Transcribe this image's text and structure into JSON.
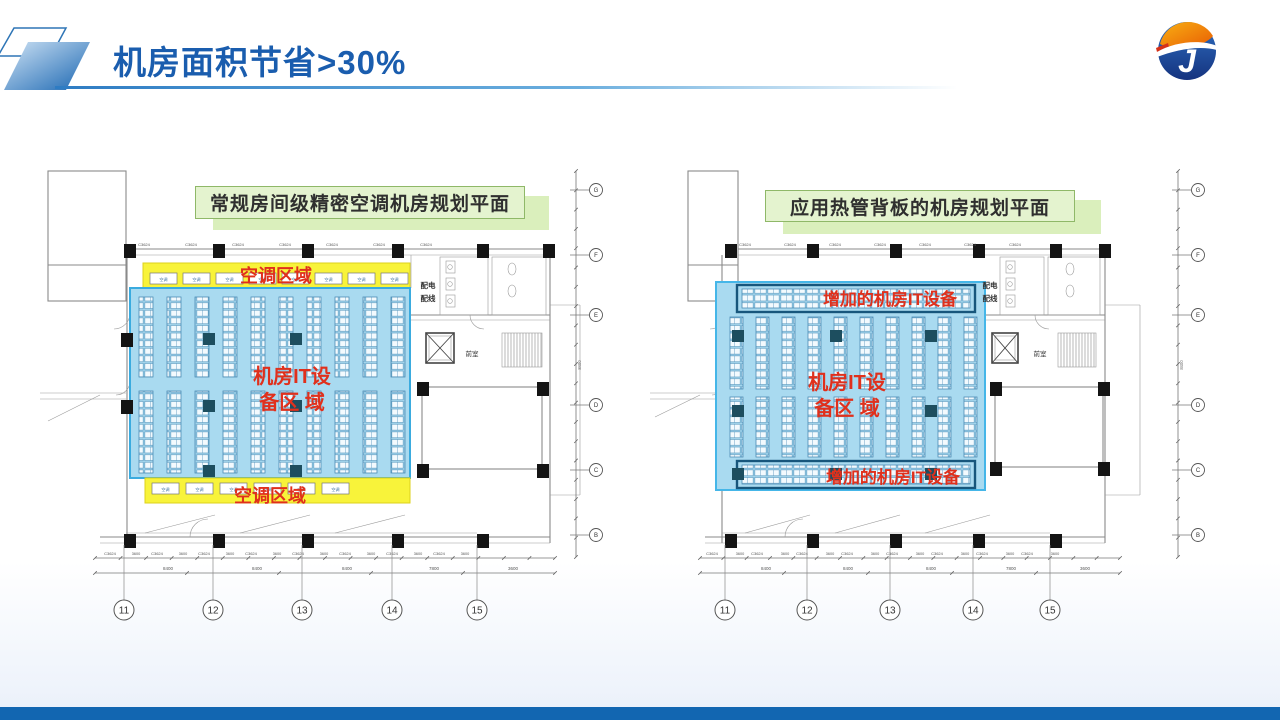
{
  "header": {
    "title": "机房面积节省>30%"
  },
  "plan_left": {
    "caption": "常规房间级精密空调机房规划平面",
    "label_ac_top": "空调区域",
    "label_ac_bottom": "空调区域",
    "label_it_line1": "机房IT设",
    "label_it_line2": "备区 域",
    "room_power_line1": "配电",
    "room_power_line2": "配线",
    "room_lobby": "前室",
    "window_label": "C3624",
    "ac_unit_label": "空调",
    "grid_bubbles": [
      "11",
      "12",
      "13",
      "14",
      "15"
    ],
    "vgrid_bubbles": [
      "G",
      "F",
      "E",
      "D",
      "C",
      "B"
    ],
    "dim_small": "3600",
    "dim_totals": [
      "8400",
      "8400",
      "8400",
      "7800",
      "3600"
    ],
    "dim_vertical": "8400"
  },
  "plan_right": {
    "caption": "应用热管背板的机房规划平面",
    "label_added_top": "增加的机房IT设备",
    "label_added_bottom": "增加的机房IT设备",
    "label_it_line1": "机房IT设",
    "label_it_line2": "备区 域",
    "room_power_line1": "配电",
    "room_power_line2": "配线",
    "room_lobby": "前室",
    "window_label": "C3624",
    "ac_unit_label": "空调",
    "grid_bubbles": [
      "11",
      "12",
      "13",
      "14",
      "15"
    ],
    "vgrid_bubbles": [
      "G",
      "F",
      "E",
      "D",
      "C",
      "B"
    ],
    "dim_small": "3600",
    "dim_totals": [
      "8400",
      "8400",
      "8400",
      "7800",
      "3600"
    ],
    "dim_vertical": "8400"
  },
  "colors": {
    "accent_blue": "#1a5dae",
    "zone_yellow": "#f8f33a",
    "zone_blue": "#a9daf0",
    "zone_blue_border": "#3aabdf",
    "strip_border_dark": "#17567c",
    "red_label": "#e0301c",
    "caption_bg": "#e4f3cf",
    "caption_border": "#8fb868",
    "footer_blue": "#1266b1"
  }
}
